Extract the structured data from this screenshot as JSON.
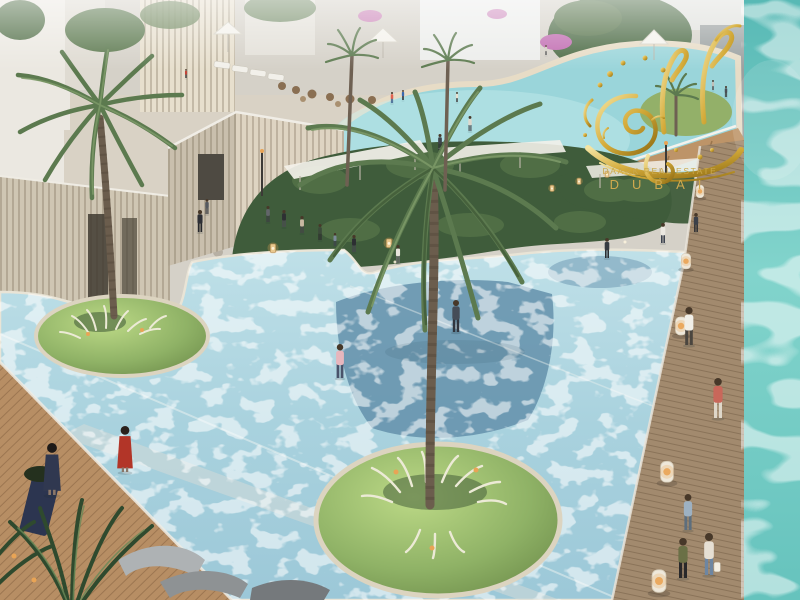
{
  "meta": {
    "description": "Aerial architectural rendering of a resort pool plaza with palm trees, shallow leisure pool, wooden decks and pedestrians",
    "brand_watermark_style": "gold arabic calligraphy"
  },
  "watermark": {
    "line1": "DAARK REAL ESTATE",
    "line2": "DUBAI",
    "gold": "#c9a227"
  },
  "colors": {
    "plaza": "#d5d1c8",
    "sand": "#e6dcc8",
    "wall": "#cfc6b3",
    "cubeLight": "#ded4c2",
    "cubeDark": "#c9bfad",
    "door": "#4e4a42",
    "hedge": "#3f5c3b",
    "hedgeLight": "#5e7e4e",
    "canopy": "#f3f1ea",
    "upperPool": "#9ad5da",
    "upperPoolLight": "#c6ecec",
    "mainPoolA": "#bfe0e8",
    "mainPoolB": "#9cc8d8",
    "deepWater": "#5f8ca8",
    "islandRim": "#dcd4c0",
    "grassA": "#bcd986",
    "grassB": "#8fb266",
    "grassC": "#6d8c4a",
    "tuft": "#ecead6",
    "trunk": "#6b5d4d",
    "frond": "#5c7a4f",
    "frondDark": "#455f3b",
    "frondLight": "#7d9a68",
    "deckLeft": "#b78e64",
    "deckRight": "#a28a6e",
    "ramp": "#bd9468",
    "oceanA": "#58b9b5",
    "oceanB": "#82d4cc",
    "oceanC": "#66c3bd",
    "lawn": "#93b069",
    "building": "#ebe8e1",
    "buildingGray": "#9aa0a0",
    "flower": "#c06ab0",
    "amber": "#e9a455",
    "lounger": "#9aa0a2",
    "planter": "#2c3550",
    "white": "#f4f2ec"
  },
  "scene": {
    "people": [
      {
        "id": "plaza-1",
        "x": 268,
        "y": 222,
        "h": 16,
        "shirt": "#62656a",
        "pants": "#3c3e42"
      },
      {
        "id": "plaza-2",
        "x": 284,
        "y": 227,
        "h": 17,
        "shirt": "#2e3033",
        "pants": "#4a4c50"
      },
      {
        "id": "plaza-3",
        "x": 302,
        "y": 233,
        "h": 17,
        "shirt": "#c8b8a2",
        "pants": "#454545"
      },
      {
        "id": "plaza-4",
        "x": 320,
        "y": 240,
        "h": 16,
        "shirt": "#3c4a3a",
        "pants": "#2e2e2e"
      },
      {
        "id": "plaza-5",
        "x": 335,
        "y": 246,
        "h": 13,
        "shirt": "#7b8a99",
        "pants": "#3f434c"
      },
      {
        "id": "plaza-6",
        "x": 354,
        "y": 252,
        "h": 17,
        "shirt": "#2c2e32",
        "pants": "#44474c"
      },
      {
        "id": "plaza-7",
        "x": 398,
        "y": 263,
        "h": 18,
        "shirt": "#e9e5dc",
        "pants": "#6e6e6e"
      },
      {
        "id": "pool-edge-man",
        "x": 200,
        "y": 232,
        "h": 22,
        "shirt": "#2d2f35",
        "pants": "#26282c"
      },
      {
        "id": "cube-visitor",
        "x": 207,
        "y": 214,
        "h": 15,
        "shirt": "#55595f",
        "pants": "#3b3d41"
      },
      {
        "id": "plaza-8",
        "x": 607,
        "y": 258,
        "h": 20,
        "shirt": "#363b42",
        "pants": "#2b2d31"
      },
      {
        "id": "plaza-9",
        "x": 663,
        "y": 243,
        "h": 20,
        "shirt": "#ebe8e1",
        "pants": "#3e4450"
      },
      {
        "id": "plaza-10",
        "x": 696,
        "y": 232,
        "h": 19,
        "shirt": "#3b4049",
        "pants": "#2c2e33"
      },
      {
        "id": "upper-plaza-1",
        "x": 726,
        "y": 97,
        "h": 11,
        "shirt": "#4a4f57",
        "pants": "#3a3a3a"
      },
      {
        "id": "upper-plaza-2",
        "x": 713,
        "y": 90,
        "h": 10,
        "shirt": "#c2bfb8",
        "pants": "#5a5a5a"
      },
      {
        "id": "upper-pool-1",
        "x": 392,
        "y": 103,
        "h": 11,
        "shirt": "#e2614f",
        "pants": "#3a5a8a"
      },
      {
        "id": "upper-pool-2",
        "x": 403,
        "y": 100,
        "h": 10,
        "shirt": "#3a6ab0",
        "pants": "#343434"
      },
      {
        "id": "upper-pool-3",
        "x": 457,
        "y": 102,
        "h": 10,
        "shirt": "#e8e0d0",
        "pants": "#4a4a4a"
      },
      {
        "id": "upper-pool-4",
        "x": 546,
        "y": 55,
        "h": 10,
        "shirt": "#d2cec2",
        "pants": "#5a5a5a"
      },
      {
        "id": "upper-pool-5",
        "x": 186,
        "y": 78,
        "h": 9,
        "shirt": "#c24438",
        "pants": "#3a3a3a"
      },
      {
        "id": "ramp-walker-1",
        "x": 440,
        "y": 150,
        "h": 16,
        "shirt": "#3f444b",
        "pants": "#2e3035"
      },
      {
        "id": "ramp-walker-2",
        "x": 470,
        "y": 131,
        "h": 15,
        "shirt": "#ddd8ce",
        "pants": "#4e5258"
      },
      {
        "id": "wader-pink",
        "x": 340,
        "y": 378,
        "h": 34,
        "shirt": "#e7b6bd",
        "pants": "#49536a"
      },
      {
        "id": "wader-hoodie",
        "x": 456,
        "y": 332,
        "h": 32,
        "shirt": "#454d58",
        "pants": "#31363e"
      },
      {
        "id": "wader-red-dress",
        "x": 125,
        "y": 472,
        "h": 46,
        "shirt": "#b23528",
        "pants": "#b23528",
        "type": "dress",
        "hair": "#2a211c"
      },
      {
        "id": "deck-left-woman",
        "x": 52,
        "y": 495,
        "h": 52,
        "shirt": "#303850",
        "pants": "#303850",
        "type": "dress",
        "hair": "#1e1a18"
      },
      {
        "id": "deck-right-1",
        "x": 689,
        "y": 345,
        "h": 38,
        "shirt": "#f1efe8",
        "pants": "#4b463f"
      },
      {
        "id": "deck-right-2",
        "x": 718,
        "y": 418,
        "h": 40,
        "shirt": "#c9675a",
        "pants": "#ded7ca"
      },
      {
        "id": "deck-right-3",
        "x": 688,
        "y": 530,
        "h": 36,
        "shirt": "#9db1c2",
        "pants": "#5d6e7d"
      },
      {
        "id": "deck-right-4",
        "x": 683,
        "y": 578,
        "h": 40,
        "shirt": "#6a7046",
        "pants": "#28282a"
      },
      {
        "id": "deck-right-5",
        "x": 709,
        "y": 575,
        "h": 42,
        "shirt": "#e6dfd3",
        "pants": "#6d86a2",
        "bag": true
      }
    ],
    "bollards": [
      {
        "x": 700,
        "y": 197,
        "s": 0.7
      },
      {
        "x": 686,
        "y": 268,
        "s": 0.85
      },
      {
        "x": 681,
        "y": 334,
        "s": 1
      },
      {
        "x": 667,
        "y": 481,
        "s": 1.15
      },
      {
        "x": 659,
        "y": 591,
        "s": 1.25
      }
    ],
    "lanterns": [
      {
        "x": 273,
        "y": 252,
        "s": 1
      },
      {
        "x": 389,
        "y": 247,
        "s": 1
      },
      {
        "x": 552,
        "y": 191,
        "s": 0.7
      },
      {
        "x": 579,
        "y": 184,
        "s": 0.7
      },
      {
        "x": 607,
        "y": 177,
        "s": 0.7
      }
    ]
  }
}
